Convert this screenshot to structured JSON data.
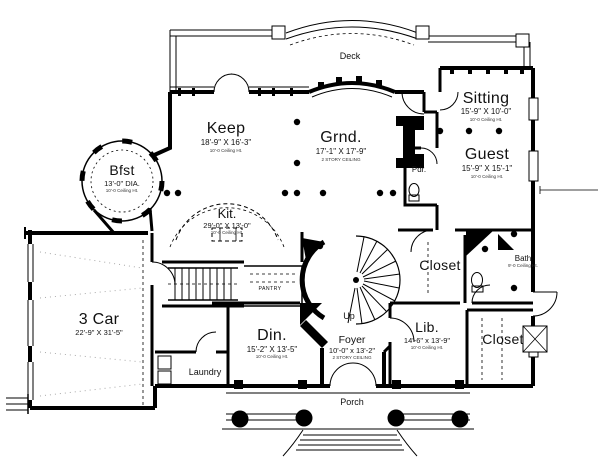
{
  "plan": {
    "deck": {
      "label": "Deck"
    },
    "sitting": {
      "name": "Sitting",
      "dims": "15'-9\" X 10'-0\"",
      "note": "10'-0 Ceiling Ht."
    },
    "keep": {
      "name": "Keep",
      "dims": "18'-9\" X 16'-3\"",
      "note": "10'-0 Ceiling Ht."
    },
    "grnd": {
      "name": "Grnd.",
      "dims": "17'-1\" X 17'-9\"",
      "note": "2 STORY CEILING"
    },
    "guest": {
      "name": "Guest",
      "dims": "15'-9\" X 15'-1\"",
      "note": "10'-0 Ceiling Ht."
    },
    "bfst": {
      "name": "Bfst",
      "dims": "13'-0\" DIA.",
      "note": "10'-0 Ceiling Ht."
    },
    "kit": {
      "name": "Kit.",
      "dims": "29'-0\" X 13'-0\"",
      "note": "10'-0 Ceiling Ht."
    },
    "pdr": {
      "name": "Pdr."
    },
    "garage": {
      "name": "3 Car",
      "dims": "22'-9\" X 31'-5\""
    },
    "pantry": {
      "name": "PANTRY"
    },
    "din": {
      "name": "Din.",
      "dims": "15'-2\" X 13'-5\"",
      "note": "10'-0 Ceiling Ht."
    },
    "laundry": {
      "name": "Laundry"
    },
    "foyer": {
      "name": "Foyer",
      "dims": "10'-0\" x 13'-2\"",
      "note": "2 STORY CEILING"
    },
    "up": {
      "label": "Up"
    },
    "lib": {
      "name": "Lib.",
      "dims": "14'-6\" x 13'-9\"",
      "note": "10'-0 Ceiling Ht."
    },
    "closet_upper": {
      "name": "Closet"
    },
    "bath": {
      "name": "Bath",
      "note": "9'-0 Ceiling Ht."
    },
    "closet_lower": {
      "name": "Closet"
    },
    "porch": {
      "label": "Porch"
    }
  },
  "colors": {
    "line": "#000000",
    "background": "#ffffff"
  }
}
